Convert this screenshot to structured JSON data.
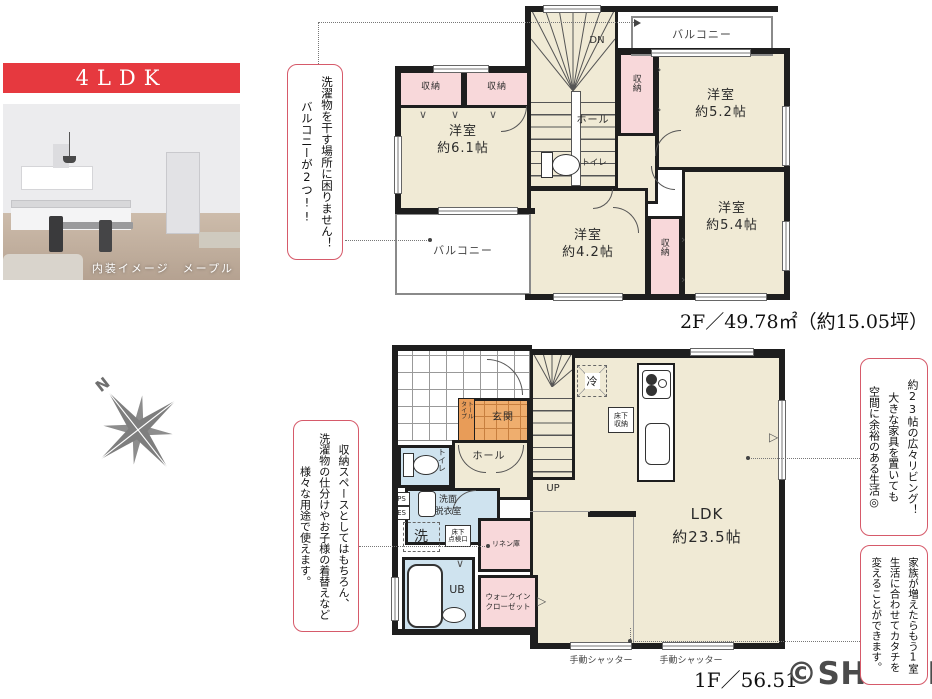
{
  "badge": "4LDK",
  "photo": {
    "caption": "内装イメージ　メープル"
  },
  "compass": {
    "north": "N"
  },
  "watermark": "©SHIZUNAVI",
  "floor2": {
    "area_label": "2F／49.78㎡（約15.05坪）",
    "balcony_top": "バルコニー",
    "balcony_side": "バルコニー",
    "stairs_down": "DN",
    "hall": "ホール",
    "toilet": "トイレ",
    "closets": [
      "収納",
      "収納",
      "収納",
      "収納"
    ],
    "room_61": "洋室\n約6.1帖",
    "room_52": "洋室\n約5.2帖",
    "room_42": "洋室\n約4.2帖",
    "room_54": "洋室\n約5.4帖"
  },
  "floor1": {
    "area_label": "1F／56.51",
    "genkan": "玄関",
    "shoebox": "トール\nタイプ",
    "stairs_up": "UP",
    "hall": "ホール",
    "toilet": "トイレ",
    "fridge": "冷",
    "underfloor_storage": "床下\n収納",
    "ldk": "LDK\n約23.5帖",
    "washroom": "洗面\n脱衣室",
    "washer": "洗",
    "inspection": "床下\n点検口",
    "linen": "リネン庫",
    "bath": "UB",
    "wic": "ウォークイン\nクローゼット",
    "ps": "PS",
    "es": "ES",
    "shutters": [
      "手動シャッター",
      "手動シャッター"
    ]
  },
  "annotations": {
    "balcony": {
      "lines": [
        "洗濯物を干す場所に困りません！",
        "バルコニーが2つ!!"
      ]
    },
    "storage": {
      "lines": [
        "収納スペースとしてはもちろん、",
        "洗濯物の仕分けやお子様の着替えなど",
        "様々な用途で使えます。"
      ]
    },
    "living": {
      "lines": [
        "約23帖の広々リビング！",
        "大きな家具を置いても",
        "空間に余裕のある生活◎"
      ]
    },
    "flex": {
      "lines": [
        "家族が増えたらもう1室",
        "生活に合わせてカタチを",
        "変えることができます。"
      ]
    }
  },
  "colors": {
    "accent_red": "#e6393f",
    "callout_border": "#d65a6a",
    "room_beige": "#f0ead5",
    "closet_pink": "#f8d8da",
    "wet_blue": "#cfe3ef",
    "genkan_orange": "#efae6e",
    "wall": "#1e1e1e",
    "watermark_gray": "#4b4b4b"
  }
}
